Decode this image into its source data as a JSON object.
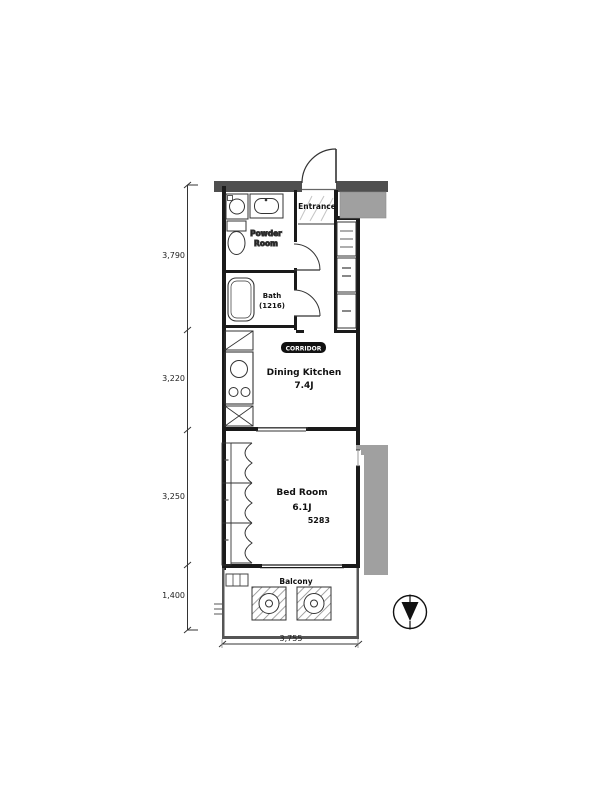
{
  "title": "apartment-floor-plan",
  "labels": {
    "entrance": "Entrance",
    "powder_1": "Powder",
    "powder_2": "Room",
    "bath_1": "Bath",
    "bath_2": "(1216)",
    "corridor_badge": "CORRIDOR",
    "dk_1": "Dining Kitchen",
    "dk_2": "7.4J",
    "bed_1": "Bed Room",
    "bed_2": "6.1J",
    "bed_3": "5283",
    "balcony": "Balcony"
  },
  "dimensions": {
    "left": [
      "3,790",
      "3,220",
      "3,250",
      "1,400"
    ],
    "bottom_width": "3,755"
  },
  "colors": {
    "wall_dark": "#4f4f4f",
    "shade_gray": "#a0a0a0",
    "line_black": "#1a1a1a",
    "badge_bg": "#111111"
  },
  "icons": {
    "compass": "north-arrow-down"
  }
}
